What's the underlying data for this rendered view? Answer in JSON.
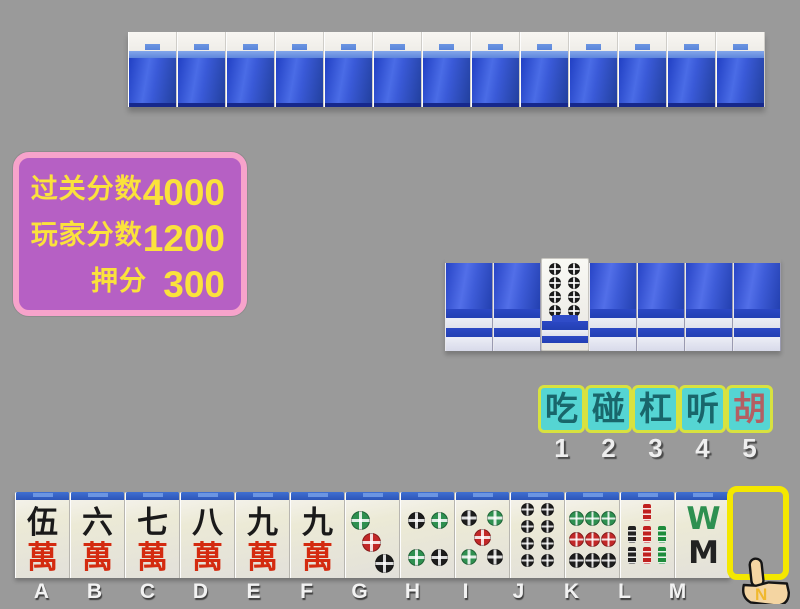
{
  "app": {
    "background_color": "#9a9a9a",
    "game": "mahjong"
  },
  "score_panel": {
    "colors": {
      "background": "#b660c4",
      "border": "#f7a3cb",
      "text": "#fbe23c"
    },
    "rows": [
      {
        "label": "过关分数",
        "value": "4000"
      },
      {
        "label": "玩家分数",
        "value": "1200"
      },
      {
        "label": "押分",
        "value": "300"
      }
    ]
  },
  "opponent_wall": {
    "tile_count": 13,
    "tile_style": "face-down-blue-back"
  },
  "right_wall": {
    "tile_count": 7,
    "tiles": [
      "back",
      "back",
      "eight-dots-face-up",
      "back",
      "back",
      "back",
      "back"
    ],
    "revealed_tile": "eight-dots"
  },
  "action_bar": {
    "colors": {
      "background": "#55d5d3",
      "border": "#d8e23f",
      "text": "#19666b",
      "hu_text": "#b35f63"
    },
    "buttons": [
      {
        "label": "吃",
        "number": "1"
      },
      {
        "label": "碰",
        "number": "2"
      },
      {
        "label": "杠",
        "number": "3"
      },
      {
        "label": "听",
        "number": "4"
      },
      {
        "label": "胡",
        "number": "5"
      }
    ]
  },
  "hand": {
    "tiles": [
      {
        "key": "A",
        "name": "five-wan",
        "top": "伍",
        "bottom": "萬"
      },
      {
        "key": "B",
        "name": "six-wan",
        "top": "六",
        "bottom": "萬"
      },
      {
        "key": "C",
        "name": "seven-wan",
        "top": "七",
        "bottom": "萬"
      },
      {
        "key": "D",
        "name": "eight-wan",
        "top": "八",
        "bottom": "萬"
      },
      {
        "key": "E",
        "name": "nine-wan",
        "top": "九",
        "bottom": "萬"
      },
      {
        "key": "F",
        "name": "nine-wan",
        "top": "九",
        "bottom": "萬"
      },
      {
        "key": "G",
        "name": "three-dots"
      },
      {
        "key": "H",
        "name": "four-dots"
      },
      {
        "key": "I",
        "name": "five-dots"
      },
      {
        "key": "J",
        "name": "eight-dots"
      },
      {
        "key": "K",
        "name": "nine-dots"
      },
      {
        "key": "L",
        "name": "seven-bamboo"
      },
      {
        "key": "M",
        "name": "eight-bamboo",
        "top_glyph": "W",
        "bottom_glyph": "M"
      }
    ]
  },
  "cursor": {
    "type": "pointing-hand",
    "letter": "N"
  }
}
